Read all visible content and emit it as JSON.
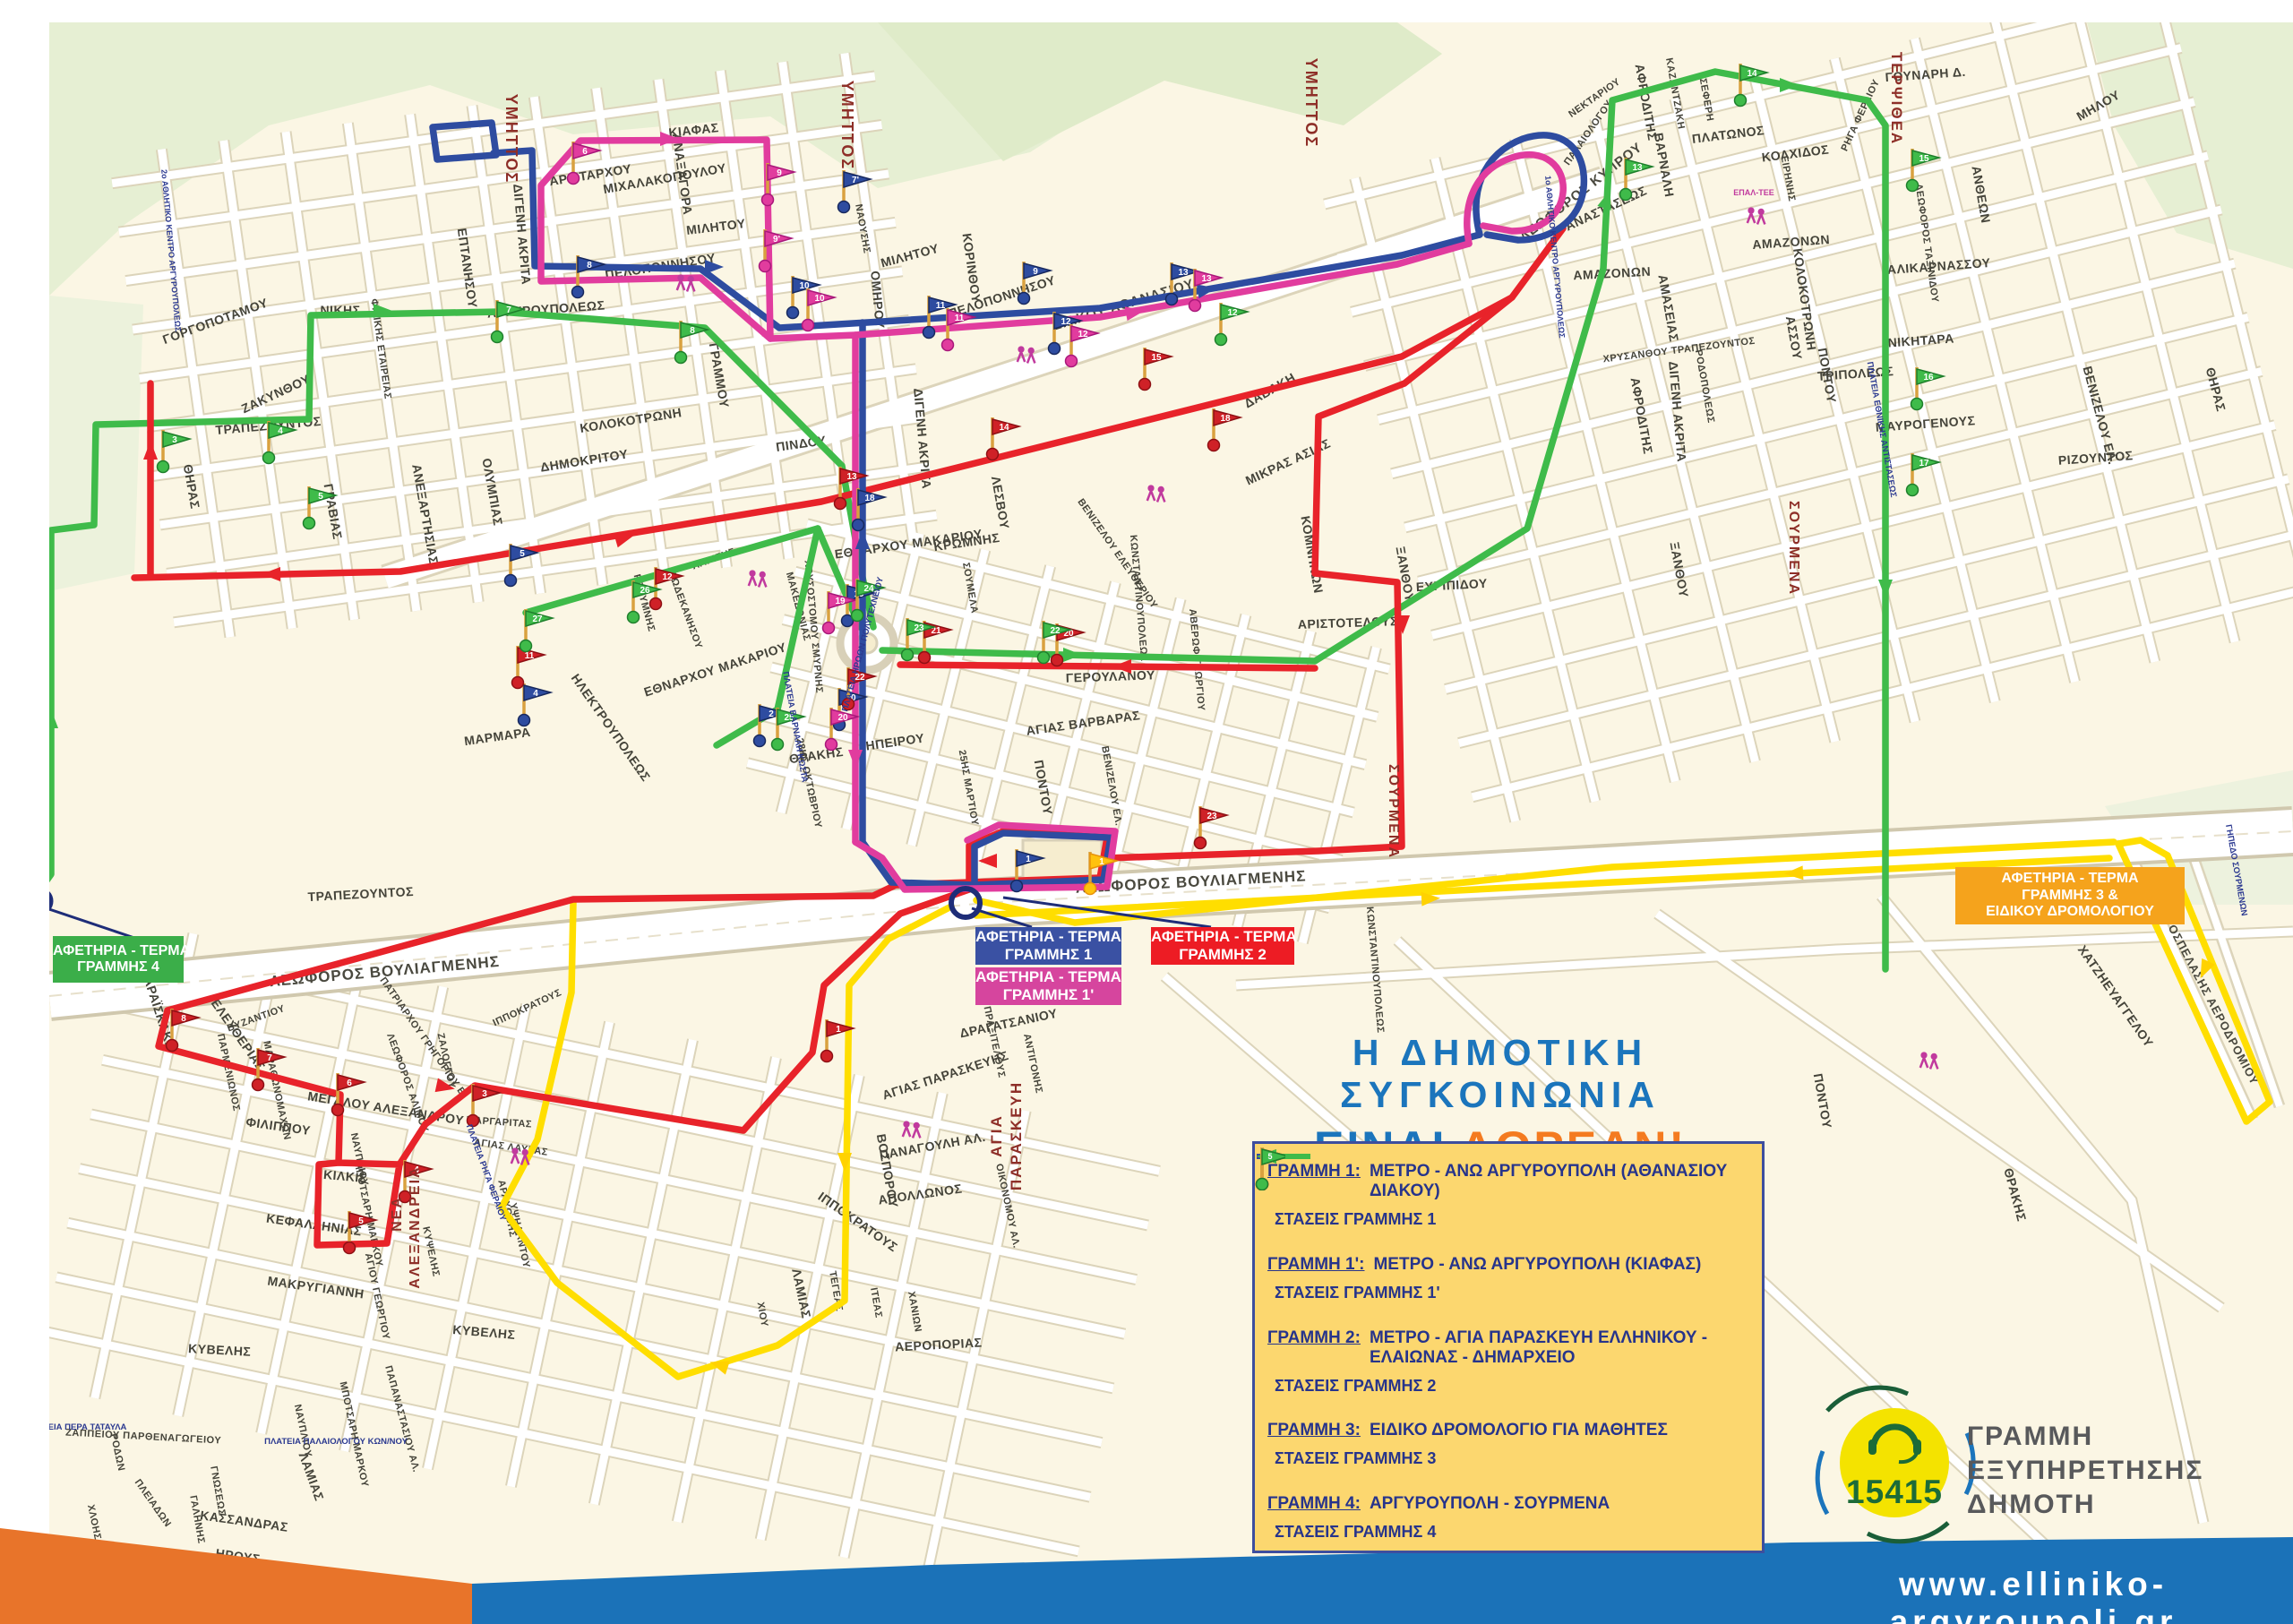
{
  "title": {
    "line1": "Η ΔΗΜΟΤΙΚΗ ΣΥΓΚΟΙΝΩΝΙΑ",
    "line2a": "ΕΙΝΑΙ",
    "line2b": "ΔΩΡΕΑΝ!"
  },
  "legend": {
    "items": [
      {
        "name": "ΓΡΑΜΜΗ 1:",
        "desc": "ΜΕΤΡΟ - ΑΝΩ ΑΡΓΥΡΟΥΠΟΛΗ (ΑΘΑΝΑΣΙΟΥ ΔΙΑΚΟΥ)",
        "stops": "ΣΤΑΣΕΙΣ ΓΡΑΜΜΗΣ 1",
        "flag_n": "2"
      },
      {
        "name": "ΓΡΑΜΜΗ 1':",
        "desc": "ΜΕΤΡΟ - ΑΝΩ ΑΡΓΥΡΟΥΠΟΛΗ (ΚΙΑΦΑΣ)",
        "stops": "ΣΤΑΣΕΙΣ ΓΡΑΜΜΗΣ 1'",
        "flag_n": "2"
      },
      {
        "name": "ΓΡΑΜΜΗ 2:",
        "desc": "ΜΕΤΡΟ - ΑΓΙΑ ΠΑΡΑΣΚΕΥΗ ΕΛΛΗΝΙΚΟΥ - ΕΛΑΙΩΝΑΣ - ΔΗΜΑΡΧΕΙΟ",
        "stops": "ΣΤΑΣΕΙΣ ΓΡΑΜΜΗΣ 2",
        "flag_n": "19"
      },
      {
        "name": "ΓΡΑΜΜΗ 3:",
        "desc": "ΕΙΔΙΚΟ ΔΡΟΜΟΛΟΓΙΟ ΓΙΑ ΜΑΘΗΤΕΣ",
        "stops": "ΣΤΑΣΕΙΣ ΓΡΑΜΜΗΣ 3",
        "flag_n": "2"
      },
      {
        "name": "ΓΡΑΜΜΗ 4:",
        "desc": "ΑΡΓΥΡΟΥΠΟΛΗ - ΣΟΥΡΜΕΝΑ",
        "stops": "ΣΤΑΣΕΙΣ ΓΡΑΜΜΗΣ 4",
        "flag_n": "5"
      }
    ]
  },
  "terminals": {
    "t1": {
      "l1": "ΑΦΕΤΗΡΙΑ - ΤΕΡΜΑ",
      "l2": "ΓΡΑΜΜΗΣ 1"
    },
    "t1p": {
      "l1": "ΑΦΕΤΗΡΙΑ - ΤΕΡΜΑ",
      "l2": "ΓΡΑΜΜΗΣ 1'"
    },
    "t2": {
      "l1": "ΑΦΕΤΗΡΙΑ - ΤΕΡΜΑ",
      "l2": "ΓΡΑΜΜΗΣ 2"
    },
    "t34": {
      "l1": "ΑΦΕΤΗΡΙΑ - ΤΕΡΜΑ",
      "l2": "ΓΡΑΜΜΗΣ 3 &",
      "l3": "ΕΙΔΙΚΟΥ ΔΡΟΜΟΛΟΓΙΟΥ"
    },
    "t4": {
      "l1": "ΑΦΕΤΗΡΙΑ - ΤΕΡΜΑ",
      "l2": "ΓΡΑΜΜΗΣ 4"
    }
  },
  "logo": {
    "number": "15415",
    "service1": "ΓΡΑΜΜΗ",
    "service2": "ΕΞΥΠΗΡΕΤΗΣΗΣ",
    "service3": "ΔΗΜΟΤΗ",
    "website": "www.elliniko-argyroupoli.gr"
  },
  "areas": {
    "ymittos": "ΥΜΗΤΤΟΣ",
    "terpsithea": "ΤΕΡΨΙΘΕΑ",
    "sourmena": "ΣΟΥΡΜΕΝΑ",
    "nea1": "ΝΕΑ",
    "nea2": "ΑΛΕΞΑΝΔΡΕΙΑ",
    "agia1": "ΑΓΙΑ",
    "agia2": "ΠΑΡΑΣΚΕΥΗ"
  },
  "roads": {
    "vouliagmenis": "ΛΕΩΦΟΡΟΣ ΒΟΥΛΙΑΓΜΕΝΗΣ",
    "diakou": "ΔΙΑΚΟΥ ΑΘΑΝΑΣΙΟΥ",
    "kyprou": "ΛΕΩΦΟΡΟΣ ΚΥΠΡΟΥ",
    "airport": "ΟΔΟΣ ΠΡΟΣΠΕΛΑΣΗΣ ΑΕΡΟΔΡΟΜΙΟΥ"
  },
  "plazas": [
    "ΠΛΑΤΕΙΑ ΗΡΩΩΝ ΠΟΛΥΤΕΧΝΕΙΟΥ",
    "ΠΛΑΤΕΙΑ ΕΘΝΙΚΗΣ ΑΝΤΙΣΤΑΣΕΩΣ",
    "ΠΛΑΤΕΙΑ ΠΑΛΑΙΟΛΟΓΟΥ ΚΩΝ/ΝΟΥ",
    "ΠΛΑΤΕΙΑ ΠΕΡΑ ΤΑΤΑΥΛΑ",
    "ΠΛΑΤΕΙΑ ΡΗΓΑ ΦΕΡΑΙΟΥ",
    "ΠΛΑΤΕΙΑ ΒΑΡΝΑΛΗ ΚΩΣΤΑ",
    "ΓΗΠΕΔΟ ΣΟΥΡΜΕΝΩΝ"
  ],
  "facilities": [
    "2ο ΑΘΛΗΤΙΚΟ ΚΕΝΤΡΟ ΑΡΓΥΡΟΥΠΟΛΕΩΣ",
    "1ο ΑΘΛΗΤΙΚΟ ΚΕΝΤΡΟ ΑΡΓΥΡΟΥΠΟΛΕΩΣ",
    "ΕΠΑΛ-ΤΕΕ"
  ],
  "streets": {
    "mixalakopoulou": "ΜΙΧΑΛΑΚΟΠΟΥΛΟΥ",
    "peloponnisou": "ΠΕΛΟΠΟΝΝΗΣΟΥ",
    "kolokotroni": "ΚΟΛΟΚΟΤΡΩΝΗ",
    "argyroupoleos": "ΑΡΓΥΡΟΥΠΟΛΕΩΣ",
    "nikis": "ΝΙΚΗΣ",
    "gorgopotamou": "ΓΟΡΓΟΠΟΤΑΜΟΥ",
    "zakynthou": "ΖΑΚΥΝΘΟΥ",
    "thiras": "ΘΗΡΑΣ",
    "gravias": "ΓΡΑΒΙΑΣ",
    "anexartisias": "ΑΝΕΞΑΡΤΗΣΙΑΣ",
    "olympias": "ΟΛΥΜΠΙΑΣ",
    "dimokritou": "ΔΗΜΟΚΡΙΤΟΥ",
    "trapezountos": "ΤΡΑΠΕΖΟΥΝΤΟΣ",
    "aristarchou": "ΑΡΙΣΤΑΡΧΟΥ",
    "anaxagora": "ΑΝΑΞΑΓΟΡΑ",
    "militou": "ΜΙΛΗΤΟΥ",
    "kiafas": "ΚΙΑΦΑΣ",
    "digeni_akrita": "ΔΙΓΕΝΗ ΑΚΡΙΤΑ",
    "filikis_etaireias": "ΦΙΛΙΚΗΣ ΕΤΑΙΡΕΙΑΣ",
    "eptanisou": "ΕΠΤΑΝΗΣΟΥ",
    "grammou": "ΓΡΑΜΜΟΥ",
    "pindou": "ΠΙΝΔΟΥ",
    "davaki": "ΔΑΒΑΚΗ",
    "korinthou": "ΚΟΡΙΝΘΟΥ",
    "omirou": "ΟΜΗΡΟΥ",
    "thrakis": "ΘΡΑΚΗΣ",
    "ipeirou": "ΗΠΕΙΡΟΥ",
    "okt28": "28ΗΣ ΟΚΤΩΒΡΙΟΥ",
    "mart25": "25ΗΣ ΜΑΡΤΙΟΥ",
    "ethnarchou_makariou": "ΕΘΝΑΡΧΟΥ ΜΑΚΑΡΙΟΥ",
    "chrysostomou_smyrnis": "ΧΡΥΣΟΣΤΟΜΟΥ ΣΜΥΡΝΗΣ",
    "agias_varvaras": "ΑΓΙΑΣ ΒΑΡΒΑΡΑΣ",
    "venizelou_el": "ΒΕΝΙΖΕΛΟΥ ΕΛ.",
    "venizelou_elefth": "ΒΕΝΙΖΕΛΟΥ ΕΛΕΥΘΕΡΙΟΥ",
    "pontou": "ΠΟΝΤΟΥ",
    "kromnis": "ΚΡΩΜΝΗΣ",
    "lesvou": "ΛΕΣΒΟΥ",
    "soumela": "ΣΟΥΜΕΛΑ",
    "mikras_asias": "ΜΙΚΡΑΣ ΑΣΙΑΣ",
    "komninon": "ΚΟΜΝΗΝΩΝ",
    "konstantinoupoleos": "ΚΩΝΣΤΑΝΤΙΝΟΥΠΟΛΕΩΣ",
    "geroulanou": "ΓΕΡΟΥΛΑΝΟΥ",
    "aristotelous": "ΑΡΙΣΤΟΤΕΛΟΥΣ",
    "averof_georgiou": "ΑΒΕΡΩΦ ΓΕΩΡΓΙΟΥ",
    "xanthou": "ΞΑΝΘΟΥ",
    "evripidou": "ΕΥΡΙΠΙΔΟΥ",
    "anastaseos": "ΑΝΑΣΤΑΣΕΩΣ",
    "amazonon": "ΑΜΑΖΟΝΩΝ",
    "amaseias": "ΑΜΑΣΕΙΑΣ",
    "assou": "ΑΣΣΟΥ",
    "afroditis": "ΑΦΡΟΔΙΤΗΣ",
    "varnali": "ΒΑΡΝΑΛΗ",
    "kazantzaki": "ΚΑΖΑΝΤΖΑΚΗ",
    "seferi": "ΣΕΦΕΡΗ",
    "platonos": "ΠΛΑΤΩΝΟΣ",
    "kolxidos": "ΚΟΛΧΙΔΟΣ",
    "eirinis": "ΕΙΡΗΝΗΣ",
    "gounari": "ΓΟΥΝΑΡΗ Δ.",
    "milou": "ΜΗΛΟΥ",
    "riga_feraiou": "ΡΗΓΑ ΦΕΡΑΙΟΥ",
    "antheon": "ΑΝΘΕΩΝ",
    "alikarnassou": "ΑΛΙΚΑΡΝΑΣΣΟΥ",
    "nikitara": "ΝΙΚΗΤΑΡΑ",
    "tripoleos": "ΤΡΙΠΟΛΕΩΣ",
    "mavrogenous": "ΜΑΥΡΟΓΕΝΟΥΣ",
    "rizountos": "ΡΙΖΟΥΝΤΟΣ",
    "chrysanthou_trap": "ΧΡΥΣΑΝΘΟΥ ΤΡΑΠΕΖΟΥΝΤΟΣ",
    "rodopoleos": "ΡΟΔΟΠΟΛΕΩΣ",
    "taxinidou": "ΛΕΩΦΟΡΟΣ ΤΑΞΙΝΙΔΟΥ",
    "naousis": "ΝΑΟΥΣΗΣ",
    "nektariou": "ΝΕΚΤΑΡΙΟΥ",
    "palaiologou": "ΠΑΛΑΙΟΛΟΓΟΥ",
    "ilektroupoleos": "ΗΛΕΚΤΡΟΥΠΟΛΕΩΣ",
    "marmara": "ΜΑΡΜΑΡΑ",
    "larisis": "ΛΑΡΙΣΗΣ",
    "rethymnis": "ΡΕΘΥΜΝΗΣ",
    "dodekanisou": "ΔΩΔΕΚΑΝΗΣΟΥ",
    "makedonias": "ΜΑΚΕΔΟΝΙΑΣ",
    "karaiskaki": "ΚΑΡΑΪΣΚΑΚΗ",
    "eleftherias": "ΕΛΕΥΘΕΡΙΑΣ",
    "meg_alexandrou": "ΜΕΓΑΛΟΥ ΑΛΕΞΑΝΔΡΟΥ",
    "filippou": "ΦΙΛΙΠΠΟΥ",
    "kilkis": "ΚΙΛΚΙΣ",
    "kefallinias": "ΚΕΦΑΛΛΗΝΙΑΣ",
    "nafpliou": "ΝΑΥΠΛΙΟΥ",
    "mpotsari": "ΜΠΟΤΣΑΡΗ ΜΑΡΚΟΥ",
    "ag_georgiou": "ΑΓΙΟΥ ΓΕΩΡΓΙΟΥ",
    "kypselis": "ΚΥΨΕΛΗΣ",
    "kyvelis": "ΚΥΒΕΛΗΣ",
    "makrygianni": "ΜΑΚΡΥΓΙΑΝΝΗ",
    "zappeiou": "ΖΑΠΠΕΙΟΥ ΠΑΡΘΕΝΑΓΩΓΕΙΟΥ",
    "kassandras": "ΚΑΣΣΑΝΔΡΑΣ",
    "irous": "ΗΡΟΥΣ",
    "pleiadon": "ΠΛΕΙΑΔΩΝ",
    "rodon": "ΡΟΔΩΝ",
    "chlois": "ΧΛΟΗΣ",
    "lamias": "ΛΑΜΙΑΣ",
    "galinis": "ΓΑΛΗΝΗΣ",
    "gnoseos": "ΓΝΩΣΕΩΣ",
    "ippokratous": "ΙΠΠΟΚΡΑΤΟΥΣ",
    "chanion": "ΧΑΝΙΩΝ",
    "tegeas": "ΤΕΓΕΑΣ",
    "iteas": "ΙΤΕΑΣ",
    "chiou": "ΧΙΟΥ",
    "aeroporias": "ΑΕΡΟΠΟΡΙΑΣ",
    "dragatsaniou": "ΔΡΑΓΑΤΣΑΝΙΟΥ",
    "ag_paraskevis": "ΑΓΙΑΣ ΠΑΡΑΣΚΕΥΗΣ",
    "panagouli": "ΠΑΝΑΓΟΥΛΗ ΑΛ.",
    "apollonos": "ΑΠΟΛΛΩΝΟΣ",
    "vosporou": "ΒΟΣΠΟΡΟΥ",
    "antigonis": "ΑΝΤΙΓΟΝΗΣ",
    "praxitelous": "ΠΡΑΞΙΤΕΛΟΥΣ",
    "oikonomou": "ΟΙΚΟΝΟΜΟΥ ΑΛ.",
    "chatzievangelou": "ΧΑΤΖΗΕΥΑΓΓΕΛΟΥ",
    "ypsilantou": "ΥΨΗΛΑΝΤΟΥ",
    "arachovis": "ΑΡΑΧΩΒΗΣ",
    "margaritas": "ΜΑΡΓΑΡΙΤΑΣ",
    "ag_lavras": "ΑΓΙΑΣ ΛΑΥΡΑΣ",
    "zaloggou": "ΖΑΛΟΓΓΟΥ",
    "patr_grigoriou": "ΠΑΤΡΙΑΡΧΟΥ ΓΡΗΓΟΡΙΟΥ Ε'",
    "leof_alimou": "ΛΕΩΦΟΡΟΣ ΑΛΙΜΟΥ",
    "vyzantiou": "ΒΥΖΑΝΤΙΟΥ",
    "papanastasiou": "ΠΑΠΑΝΑΣΤΑΣΙΟΥ ΑΛ.",
    "parmenionos": "ΠΑΡΜΕΝΙΩΝΟΣ",
    "marathonomachon": "ΜΑΡΑΘΩΝΟΜΑΧΩΝ",
    "thermopylon": "ΘΕΡΜΟΠΥΛΩΝ"
  },
  "flags": [
    {
      "n": "1",
      "c": "b"
    },
    {
      "n": "2",
      "c": "b"
    },
    {
      "n": "4",
      "c": "b"
    },
    {
      "n": "5",
      "c": "b"
    },
    {
      "n": "7'",
      "c": "b"
    },
    {
      "n": "8",
      "c": "b"
    },
    {
      "n": "9",
      "c": "b"
    },
    {
      "n": "10",
      "c": "b"
    },
    {
      "n": "11",
      "c": "b"
    },
    {
      "n": "12",
      "c": "b"
    },
    {
      "n": "13",
      "c": "b"
    },
    {
      "n": "18",
      "c": "b"
    },
    {
      "n": "19",
      "c": "b"
    },
    {
      "n": "20",
      "c": "b"
    },
    {
      "n": "6",
      "c": "m"
    },
    {
      "n": "9",
      "c": "m"
    },
    {
      "n": "9'",
      "c": "m"
    },
    {
      "n": "10",
      "c": "m"
    },
    {
      "n": "11",
      "c": "m"
    },
    {
      "n": "12",
      "c": "m"
    },
    {
      "n": "13",
      "c": "m"
    },
    {
      "n": "19",
      "c": "m"
    },
    {
      "n": "20",
      "c": "m"
    },
    {
      "n": "1",
      "c": "r"
    },
    {
      "n": "3",
      "c": "r"
    },
    {
      "n": "4",
      "c": "r"
    },
    {
      "n": "5",
      "c": "r"
    },
    {
      "n": "6",
      "c": "r"
    },
    {
      "n": "7",
      "c": "r"
    },
    {
      "n": "8",
      "c": "r"
    },
    {
      "n": "11",
      "c": "r"
    },
    {
      "n": "12",
      "c": "r"
    },
    {
      "n": "13",
      "c": "r"
    },
    {
      "n": "14",
      "c": "r"
    },
    {
      "n": "15",
      "c": "r"
    },
    {
      "n": "18",
      "c": "r"
    },
    {
      "n": "20",
      "c": "r"
    },
    {
      "n": "21",
      "c": "r"
    },
    {
      "n": "22",
      "c": "r"
    },
    {
      "n": "23",
      "c": "r"
    },
    {
      "n": "3",
      "c": "g"
    },
    {
      "n": "4",
      "c": "g"
    },
    {
      "n": "5",
      "c": "g"
    },
    {
      "n": "7",
      "c": "g"
    },
    {
      "n": "8",
      "c": "g"
    },
    {
      "n": "13",
      "c": "g"
    },
    {
      "n": "14",
      "c": "g"
    },
    {
      "n": "15",
      "c": "g"
    },
    {
      "n": "16",
      "c": "g"
    },
    {
      "n": "17",
      "c": "g"
    },
    {
      "n": "22",
      "c": "g"
    },
    {
      "n": "23",
      "c": "g"
    },
    {
      "n": "24",
      "c": "g"
    },
    {
      "n": "25",
      "c": "g"
    },
    {
      "n": "26",
      "c": "g"
    },
    {
      "n": "27",
      "c": "g"
    },
    {
      "n": "1",
      "c": "y"
    },
    {
      "n": "12",
      "c": "g"
    }
  ]
}
